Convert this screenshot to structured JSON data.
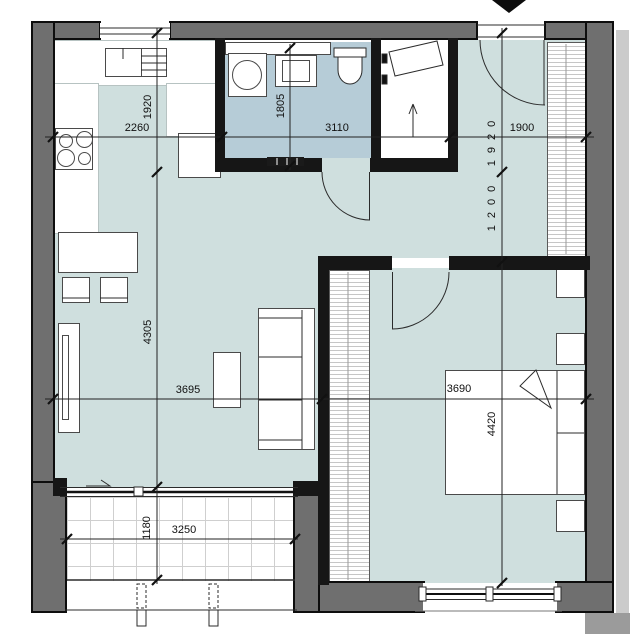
{
  "title": "apartment-floor-plan",
  "colors": {
    "outer_wall": "#6f6f6f",
    "inner_wall": "#161616",
    "floor_living": "#cfdfde",
    "floor_bathroom": "#b6ccd7",
    "floor_balcony": "#ffffff",
    "dimension_text": "#111111"
  },
  "icons": {
    "entrance_marker": "filled-triangle-down",
    "closet_direction": "up-arrow"
  },
  "dims": {
    "kitchen_w": "2260",
    "kitchen_d": "1920",
    "bath_d": "1805",
    "bath_w": "3110",
    "hall_w": "1900",
    "hall_d_upper": "1920",
    "hall_d_lower": "1200",
    "living_d": "4305",
    "living_w": "3695",
    "bedroom_w": "3690",
    "bedroom_d": "4420",
    "balcony_d": "1180",
    "balcony_w": "3250"
  }
}
